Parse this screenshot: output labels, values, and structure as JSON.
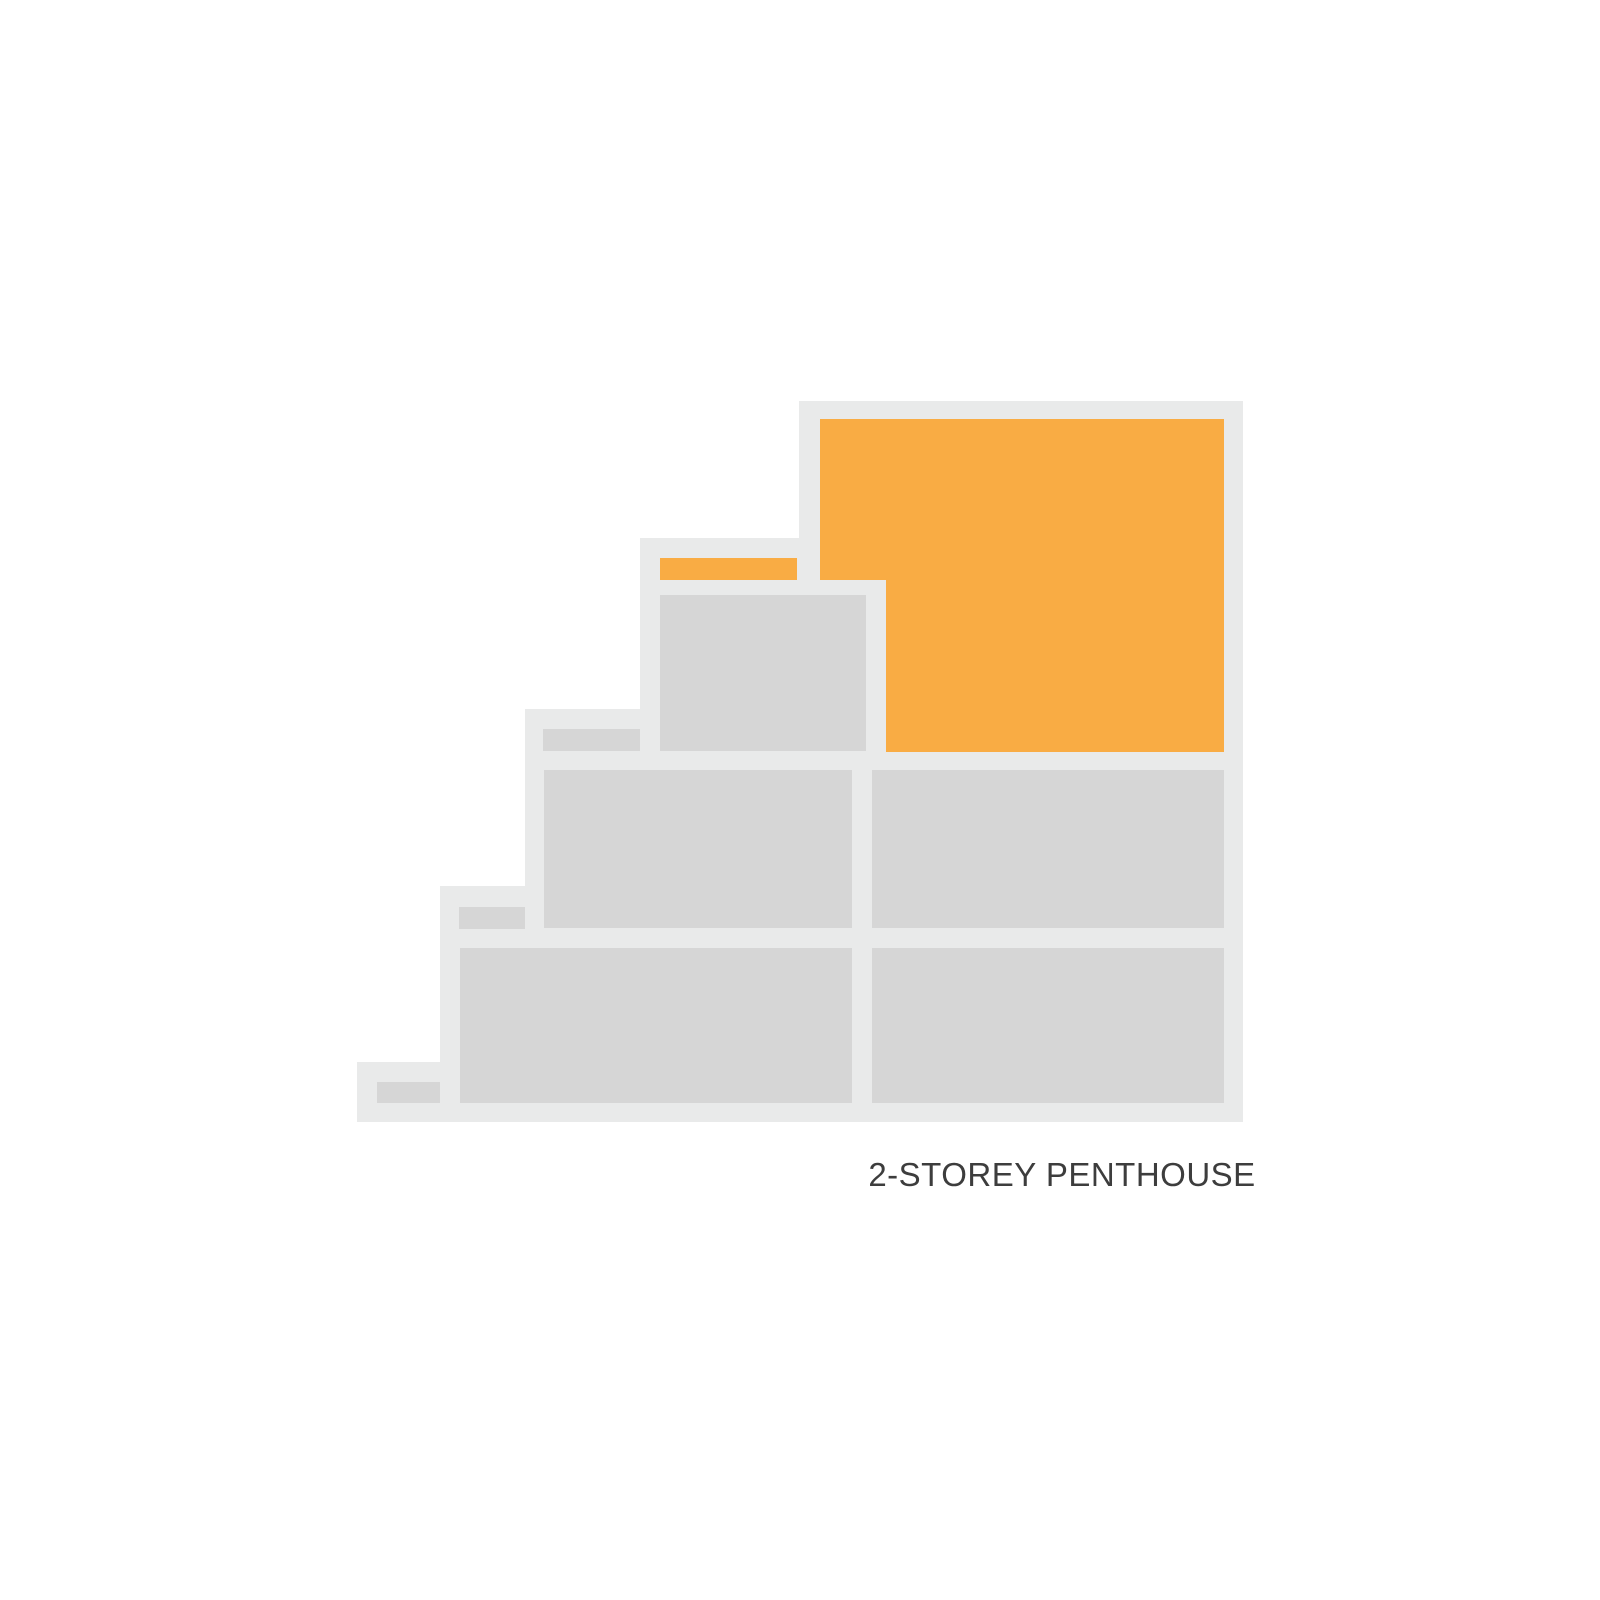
{
  "page": {
    "background": "#FFFFFF"
  },
  "diagram": {
    "type": "building-cross-section",
    "label": "2-STOREY PENTHOUSE",
    "highlighted_unit": "2-Storey Penthouse",
    "colors": {
      "background": "#FFFFFF",
      "outline": "#E9EAEA",
      "unit_gray": "#D6D6D6",
      "highlight_orange": "#F9AC44",
      "label_text": "#3D3D3D"
    },
    "structure": {
      "steps": 5,
      "levels": [
        {
          "level": 1,
          "units": [
            "grey-left",
            "grey-right"
          ],
          "terrace_marker": "grey"
        },
        {
          "level": 2,
          "units": [
            "grey-left",
            "grey-right"
          ],
          "terrace_marker": "grey"
        },
        {
          "level": 3,
          "units": [
            "grey-left",
            "penthouse-lower-storey"
          ],
          "terrace_marker": "grey"
        },
        {
          "level": 4,
          "units": [
            "penthouse-upper-storey"
          ],
          "terrace_marker": "orange"
        }
      ]
    }
  }
}
